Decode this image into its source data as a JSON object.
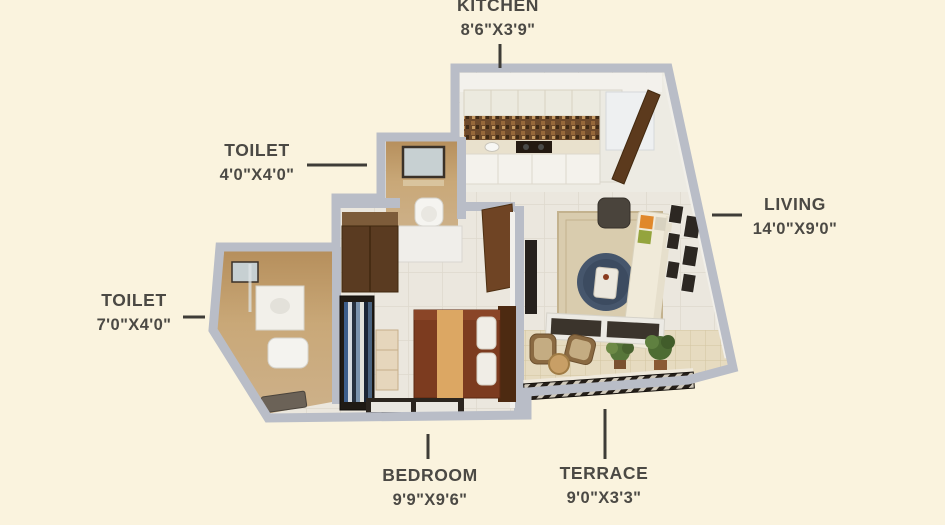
{
  "page": {
    "type": "apartment-floor-plan",
    "background": "#FAF3DE"
  },
  "palette": {
    "background": "#FAF3DE",
    "wall": "#B9BDC7",
    "text": "#4B4944",
    "leader": "#3E3C37",
    "toilet_floor_tan": "#C9A878",
    "terrace_floor": "#E6DBC0",
    "bed_maroon": "#7C3B1F",
    "door_brown": "#6F4424",
    "coffee_table_navy": "#46566C",
    "cushion_orange": "#E0882B",
    "cushion_green": "#94A43D"
  },
  "rooms": [
    {
      "id": "kitchen",
      "label": "KITCHEN",
      "dimensions": "8'6\"X3'9\""
    },
    {
      "id": "toilet_top",
      "label": "TOILET",
      "dimensions": "4'0\"X4'0\""
    },
    {
      "id": "toilet_left",
      "label": "TOILET",
      "dimensions": "7'0\"X4'0\""
    },
    {
      "id": "living",
      "label": "LIVING",
      "dimensions": "14'0\"X9'0\""
    },
    {
      "id": "bedroom",
      "label": "BEDROOM",
      "dimensions": "9'9\"X9'6\""
    },
    {
      "id": "terrace",
      "label": "TERRACE",
      "dimensions": "9'0\"X3'3\""
    }
  ]
}
